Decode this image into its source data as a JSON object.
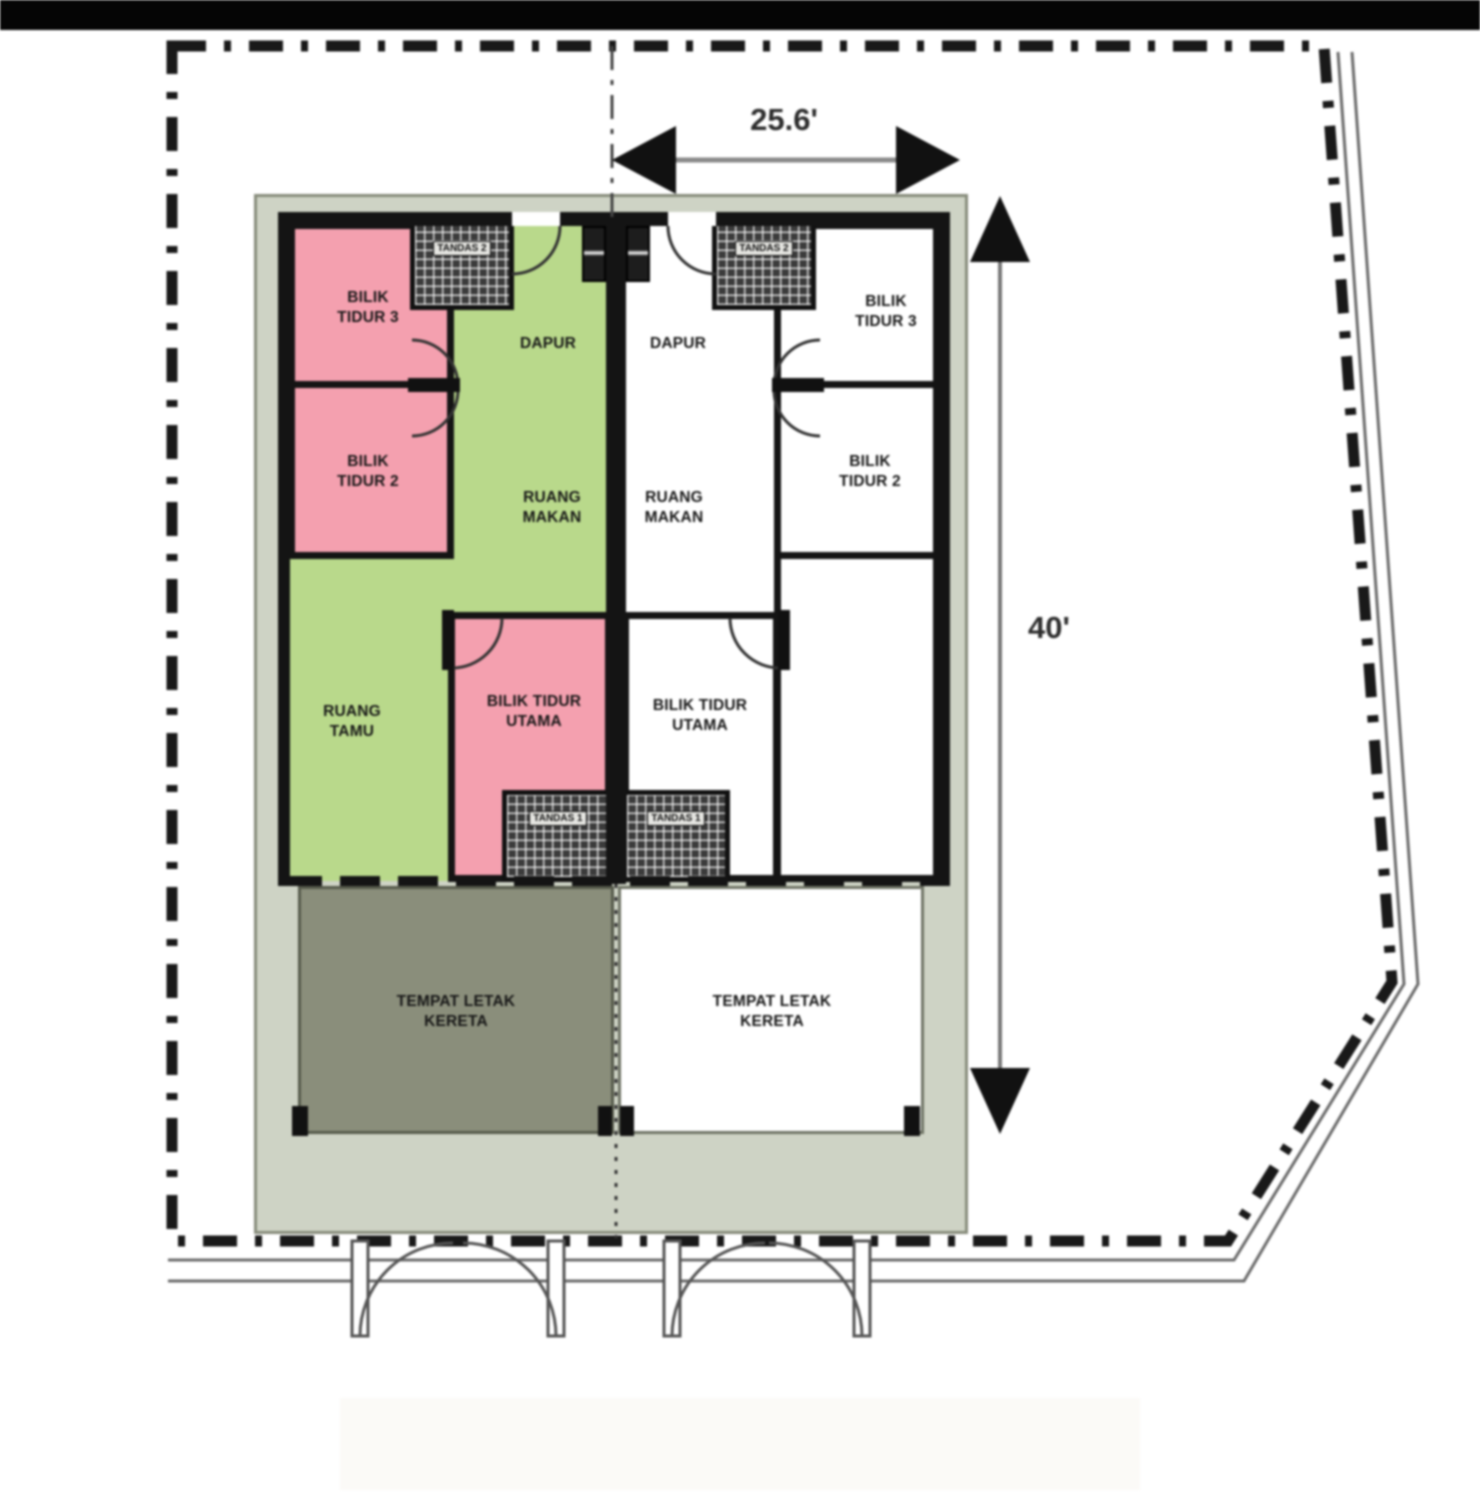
{
  "plan": {
    "type": "semi-detached house floor plan",
    "dimensions": {
      "width": "25.6'",
      "depth": "40'"
    },
    "unit_left": {
      "bilik_tidur_3": "BILIK TIDUR 3",
      "bilik_tidur_2": "BILIK TIDUR 2",
      "dapur": "DAPUR",
      "ruang_makan": "RUANG MAKAN",
      "ruang_tamu": "RUANG TAMU",
      "bilik_tidur_utama": "BILIK TIDUR UTAMA",
      "tandas_2": "TANDAS 2",
      "tandas_1": "TANDAS 1",
      "tempat_letak_kereta": "TEMPAT LETAK KERETA"
    },
    "unit_right": {
      "dapur": "DAPUR",
      "bilik_tidur_3": "BILIK TIDUR 3",
      "bilik_tidur_2": "BILIK TIDUR 2",
      "ruang_makan": "RUANG MAKAN",
      "bilik_tidur_utama": "BILIK TIDUR UTAMA",
      "tandas_2": "TANDAS 2",
      "tandas_1": "TANDAS 1",
      "tempat_letak_kereta": "TEMPAT LETAK KERETA"
    },
    "colors": {
      "bedroom_pink": "#f4a0af",
      "living_green": "#b9d98b",
      "porch_olive": "#8a8e7b",
      "apron_grey": "#ced3c5",
      "wall_black": "#141414"
    }
  }
}
